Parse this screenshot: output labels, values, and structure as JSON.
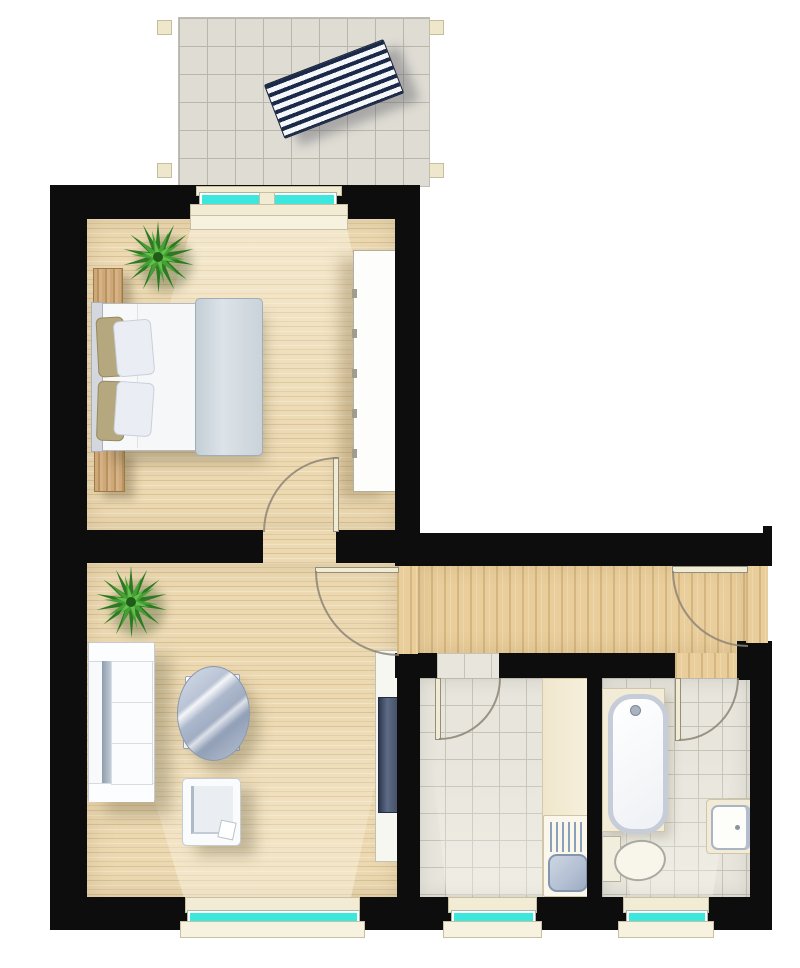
{
  "meta": {
    "description": "Top-down architectural floor plan illustration of a one-bedroom apartment with balcony; no visible text labels",
    "image_type": "floor-plan",
    "visible_text": ""
  },
  "colors": {
    "wall": "#0d0d0d",
    "wood_room": "#ecd9b2",
    "wood_hall": "#e9cd9a",
    "tile": "#e7e5dc",
    "tile_line": "#c6c4b9",
    "balcony_tile": "#dedcd3",
    "balcony_tile_line": "#b9b7ac",
    "glass": "#3ce8dd",
    "sill": "#f3ecd5",
    "sill_border": "#c9c0a2",
    "door_line": "#8d8577",
    "plant_dark": "#2d7a22",
    "plant_mid": "#46a135",
    "plant_light": "#63c04e",
    "lounger_navy": "#1c2a4a",
    "furniture_white": "#fafbfc",
    "furniture_border": "#c2c7cf",
    "glass_table": "#aab6ca",
    "tv_screen": "#46536b",
    "basin_blue": "#b2bfd3",
    "wood_furniture": "#c9a97c"
  },
  "balcony": {
    "name": "balcony",
    "floor": "gray concrete tiles",
    "items": [
      {
        "name": "sun-lounger",
        "style": "navy and white striped, rotated"
      },
      {
        "name": "corner-posts",
        "count": 4
      }
    ]
  },
  "rooms": [
    {
      "name": "bedroom",
      "floor": "light wood planks",
      "items": [
        "potted-plant",
        "nightstand-top",
        "double-bed",
        "nightstand-bottom",
        "wardrobe"
      ],
      "windows": [
        "balcony-window-door"
      ],
      "doors": [
        "bedroom-door"
      ]
    },
    {
      "name": "living-room",
      "floor": "light wood planks",
      "items": [
        "potted-plant",
        "sofa",
        "oval-glass-coffee-table",
        "armchair",
        "tv-lowboard"
      ],
      "windows": [
        "living-room-window"
      ],
      "doors": [
        "living-room-door"
      ]
    },
    {
      "name": "hallway",
      "floor": "wood strips",
      "items": [],
      "windows": [],
      "doors": [
        "entrance-door",
        "kitchen-door",
        "bathroom-door",
        "living-room-door",
        "bedroom-door"
      ]
    },
    {
      "name": "kitchen",
      "floor": "gray tiles",
      "items": [
        "kitchen-counter",
        "sink-drainboard",
        "sink-basin"
      ],
      "windows": [
        "kitchen-window"
      ],
      "doors": [
        "kitchen-door"
      ]
    },
    {
      "name": "bathroom",
      "floor": "gray tiles",
      "items": [
        "bathtub",
        "toilet",
        "washbasin"
      ],
      "windows": [
        "bathroom-window"
      ],
      "doors": [
        "bathroom-door"
      ]
    }
  ]
}
